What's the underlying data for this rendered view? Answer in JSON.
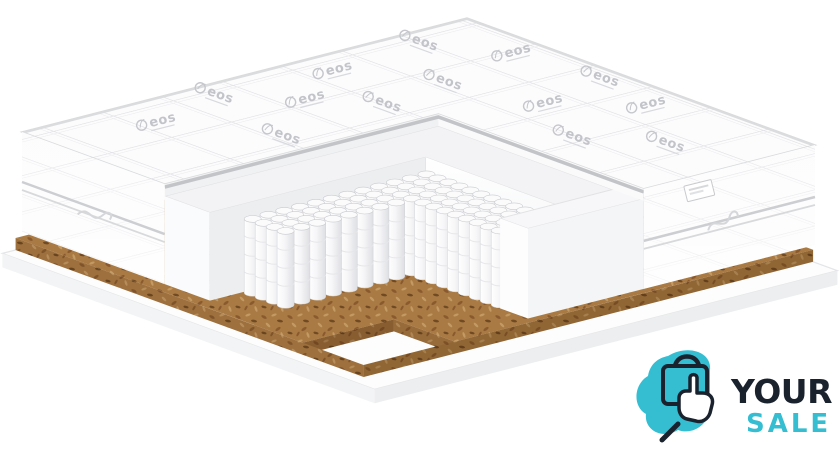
{
  "scene": {
    "width": 840,
    "height": 459,
    "background": "#ffffff"
  },
  "brand": {
    "pattern_text": "eos"
  },
  "logo": {
    "line1": "YOUR",
    "line2": "SALE"
  },
  "colors": {
    "logo_navy": "#1a222e",
    "logo_teal": "#35bdd1",
    "fabric_white": "#fcfcfd",
    "stitch_gray": "#e3e3e7",
    "stitch_soft": "#ededf0",
    "piping_gray": "#c2c4c7",
    "rim_gray": "#dbdcde",
    "foam_band": "#f3f3f5",
    "foam_face_bright": "#fdfdfe",
    "foam_face_shade": "#eceef0",
    "foam_face_outer": "#fafbfc",
    "spring_white": "#ffffff",
    "spring_mid": "#f6f6f8",
    "spring_shadow": "#dedfe3",
    "spring_stroke": "#cfd0d4",
    "coir_brown": "#a97a43",
    "coir_dark": "#8a5a2e",
    "coir_deep": "#6f4a22",
    "coir_light": "#c49a64",
    "base_white": "#fdfdfd",
    "base_edge": "#eceeef",
    "mark_gray": "#c3c4ca"
  },
  "springs": {
    "a_start": 0.555,
    "a_end": 0.92,
    "a_step": 0.0315,
    "b_start": 0.525,
    "b_end": 0.935,
    "b_step": 0.0355,
    "notch_a": 0.665,
    "notch_b": 0.645,
    "top_h": 26,
    "bottom_h": 100,
    "radius": 8.5,
    "cap_ry": 3.4
  },
  "eos_marks": [
    {
      "a": 0.06,
      "b": 0.16,
      "r": 20
    },
    {
      "a": 0.23,
      "b": 0.08,
      "r": -14
    },
    {
      "a": 0.44,
      "b": 0.05,
      "r": 20
    },
    {
      "a": 0.63,
      "b": 0.09,
      "r": -14
    },
    {
      "a": 0.82,
      "b": 0.2,
      "r": 20
    },
    {
      "a": 0.1,
      "b": 0.38,
      "r": -14
    },
    {
      "a": 0.27,
      "b": 0.27,
      "r": 20
    },
    {
      "a": 0.5,
      "b": 0.22,
      "r": -14
    },
    {
      "a": 0.68,
      "b": 0.3,
      "r": 20
    },
    {
      "a": 0.06,
      "b": 0.62,
      "r": 20
    },
    {
      "a": 0.2,
      "b": 0.52,
      "r": -14
    },
    {
      "a": 0.33,
      "b": 0.68,
      "r": 20
    },
    {
      "a": 0.13,
      "b": 0.8,
      "r": -14
    },
    {
      "a": 0.3,
      "b": 0.43,
      "r": 20
    }
  ]
}
